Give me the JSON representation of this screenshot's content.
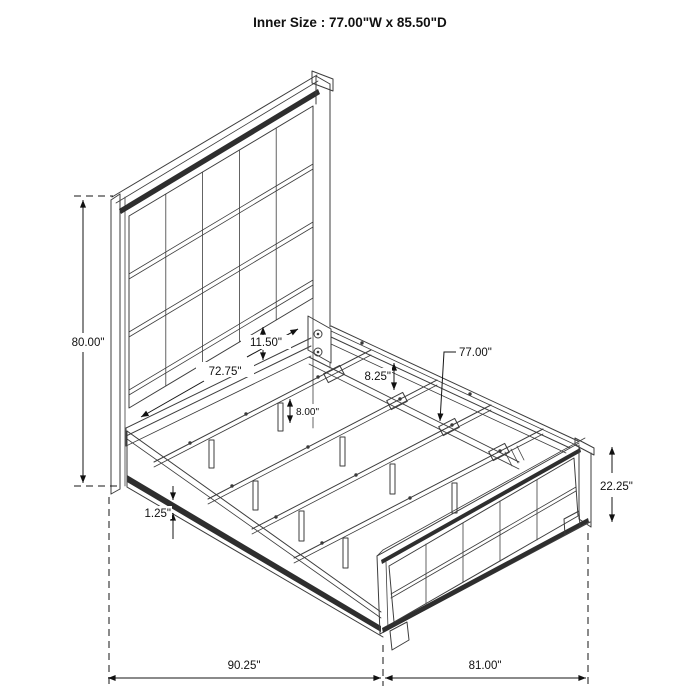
{
  "title": "Inner Size : 77.00\"W x 85.50\"D",
  "diagram": "bed-frame-dimension-drawing",
  "colors": {
    "line": "#3d3d3d",
    "dark_band": "#2e2e2e",
    "dimension": "#161616",
    "background": "#ffffff"
  },
  "dimensions": {
    "overall_height": {
      "label": "80.00\""
    },
    "inner_width_head": {
      "label": "72.75\""
    },
    "panel_gap": {
      "label": "11.50\""
    },
    "side_rail_height": {
      "label": "8.25\""
    },
    "slat_span": {
      "label": "77.00\""
    },
    "leg_height": {
      "label": "8.00\""
    },
    "rail_lip": {
      "label": "1.25\""
    },
    "footboard_height": {
      "label": "22.25\""
    },
    "overall_depth": {
      "label": "90.25\""
    },
    "overall_width": {
      "label": "81.00\""
    }
  }
}
